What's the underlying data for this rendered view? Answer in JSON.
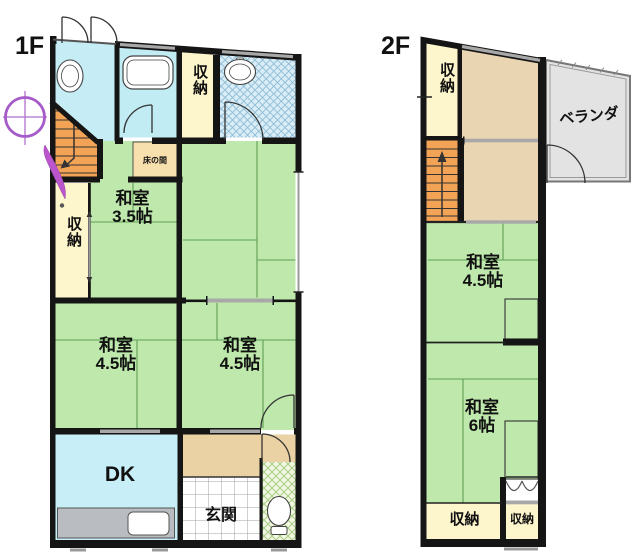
{
  "plan": {
    "floor1": {
      "label": "1F",
      "storage_top": "収納",
      "storage_left": "収納",
      "tokonoma": "床の間",
      "washitsu35": {
        "line1": "和室",
        "line2": "3.5帖"
      },
      "washitsu45_left": {
        "line1": "和室",
        "line2": "4.5帖"
      },
      "washitsu45_right": {
        "line1": "和室",
        "line2": "4.5帖"
      },
      "dk": "DK",
      "genkan": "玄関"
    },
    "floor2": {
      "label": "2F",
      "storage_top": "収納",
      "veranda": "ベランダ",
      "washitsu45": {
        "line1": "和室",
        "line2": "4.5帖"
      },
      "washitsu6": {
        "line1": "和室",
        "line2": "6帖"
      },
      "storage_bottom_left": "収納",
      "storage_bottom_right": "収納"
    },
    "colors": {
      "tatami_green": "#bfe8ac",
      "tatami_line": "#5f9e54",
      "storage_cream": "#fdf5cc",
      "water_cyan": "#c6edf6",
      "bath_cyan": "#c2ecf4",
      "dk_cyan": "#c8eef8",
      "stairs_orange": "#f2a355",
      "tokonoma_peach": "#f8dfae",
      "hall_tan": "#ebd2a4",
      "room_tan_2f": "#e9d5b2",
      "veranda_gray": "#e3e3e3",
      "wall_black": "#151515",
      "compass_purple": "#a55bc8"
    }
  }
}
